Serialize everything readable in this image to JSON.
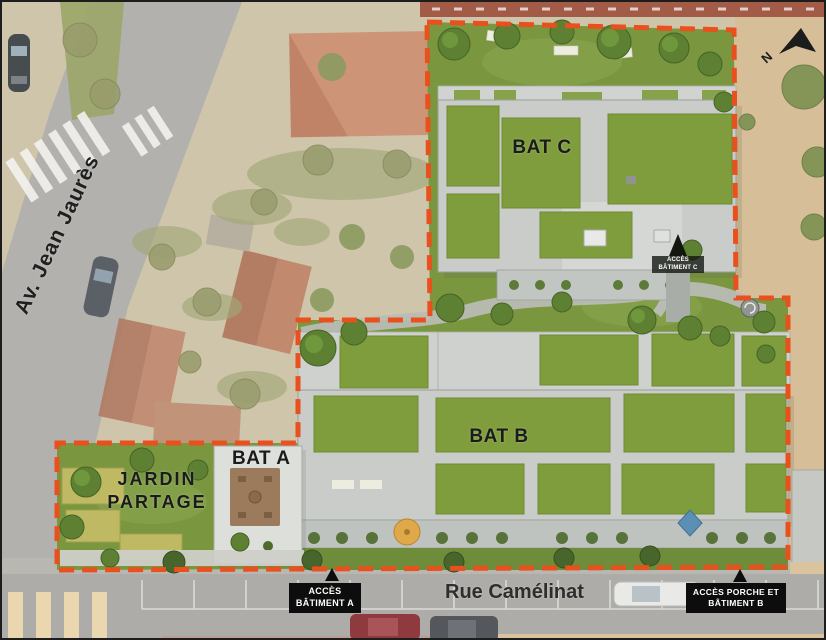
{
  "title": "residence-aerial-site-plan",
  "colors": {
    "boundary": "#e8501e",
    "lawn": "#7a9740",
    "green_roof": "#7f9d3c",
    "roof_gray": "#c9ccc9",
    "road": "#b1b0ac",
    "context_ground": "#cfc5ab",
    "sand": "#d6bf98",
    "red_roof": "#cc8a6d",
    "crosswalk": "#ead7b0",
    "label_box": "#0d0d0d",
    "label_text": "#ffffff"
  },
  "streets": {
    "avenue": "Av. Jean Jaurès",
    "rue": "Rue Camélinat"
  },
  "buildings": {
    "a": {
      "label": "BAT A"
    },
    "b": {
      "label": "BAT B"
    },
    "c": {
      "label": "BAT C"
    }
  },
  "garden": {
    "line1": "JARDIN",
    "line2": "PARTAGE"
  },
  "access": {
    "batiment_a": {
      "line1": "ACCÈS",
      "line2": "BÂTIMENT A"
    },
    "porche_b": {
      "line1": "ACCÈS PORCHE ET",
      "line2": "BÂTIMENT B"
    },
    "batiment_c": {
      "line1": "ACCÈS",
      "line2": "BÂTIMENT C"
    }
  },
  "compass": {
    "n": "N"
  }
}
